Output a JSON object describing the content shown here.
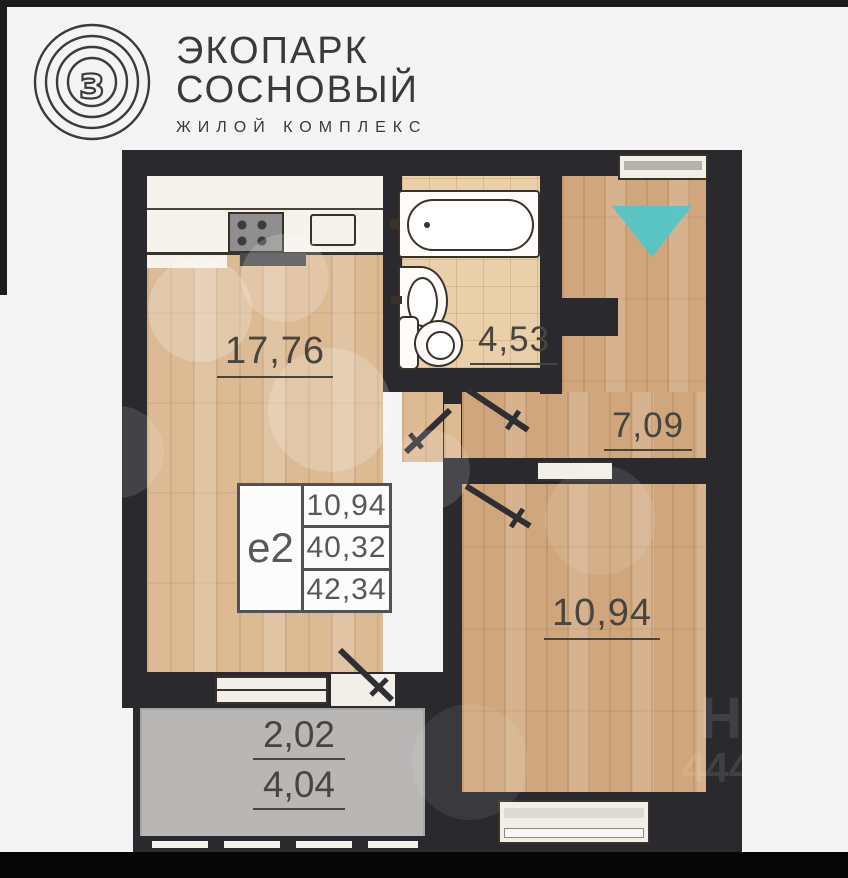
{
  "header": {
    "logo_glyph": "з",
    "title_line1": "ЭКОПАРК",
    "title_line2": "СОСНОВЫЙ",
    "subtitle": "ЖИЛОЙ КОМПЛЕКС"
  },
  "floor_plan": {
    "room_labels": {
      "living_kitchen": "17,76",
      "bathroom": "4,53",
      "hallway": "7,09",
      "bedroom": "10,94",
      "balcony_reduced": "2,02",
      "balcony_full": "4,04"
    },
    "info_box": {
      "unit_type": "е2",
      "rows": [
        "10,94",
        "40,32",
        "42,34"
      ]
    },
    "colors": {
      "accent_teal": "#4fc7c9",
      "wall": "#2a292e"
    }
  },
  "watermark": {
    "mark1": "Н",
    "mark2": "444"
  }
}
